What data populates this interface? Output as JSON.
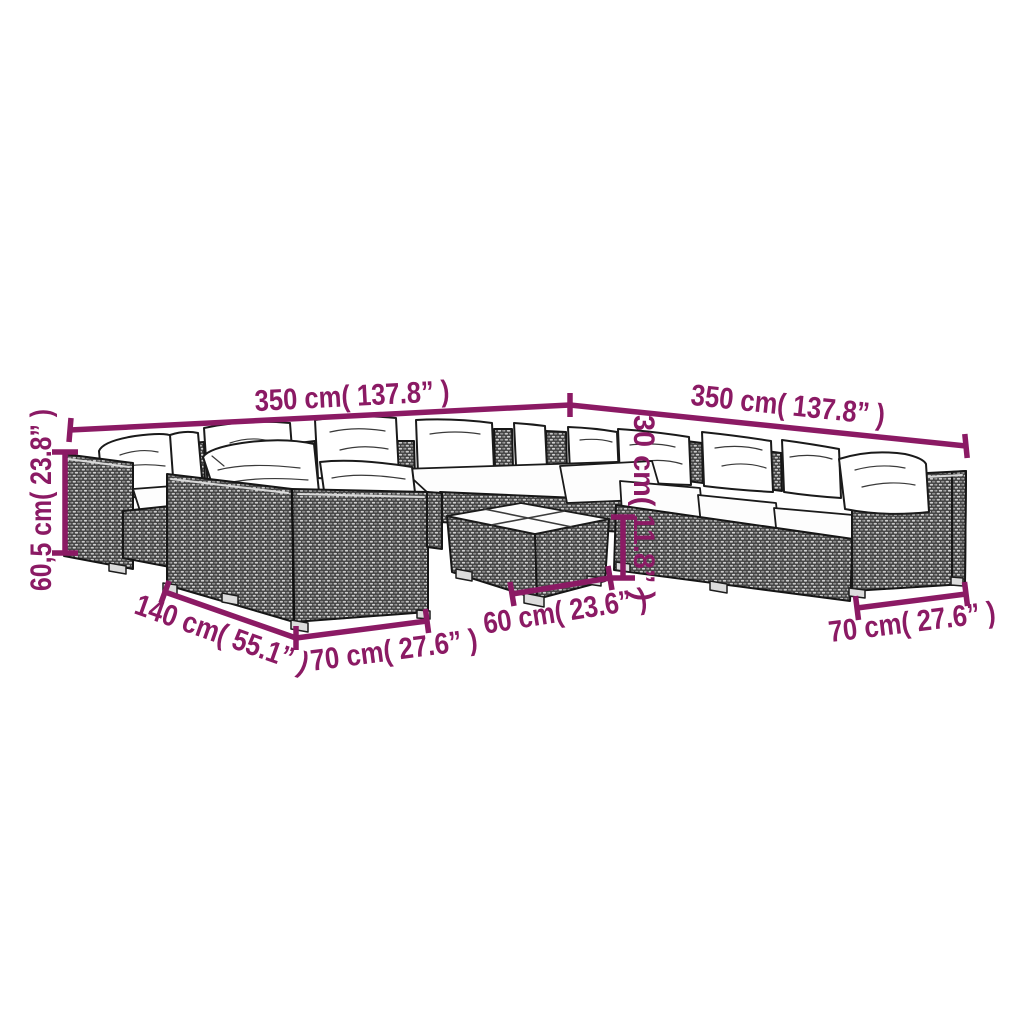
{
  "diagram": {
    "accent_color": "#8B1A64",
    "furniture_frame_color": "#414141",
    "cushion_color": "#ffffff",
    "dimensions": {
      "top_left_width": "350 cm( 137.8” )",
      "top_right_width": "350 cm( 137.8” )",
      "left_height": "60,5 cm( 23.8” )",
      "table_height": "30 cm( 11.8” )",
      "left_depth": "140 cm( 55.1” )",
      "front_left_module_width": "70 cm( 27.6” )",
      "table_width": "60 cm( 23.6” )",
      "front_right_module_width": "70 cm( 27.6” )"
    }
  }
}
